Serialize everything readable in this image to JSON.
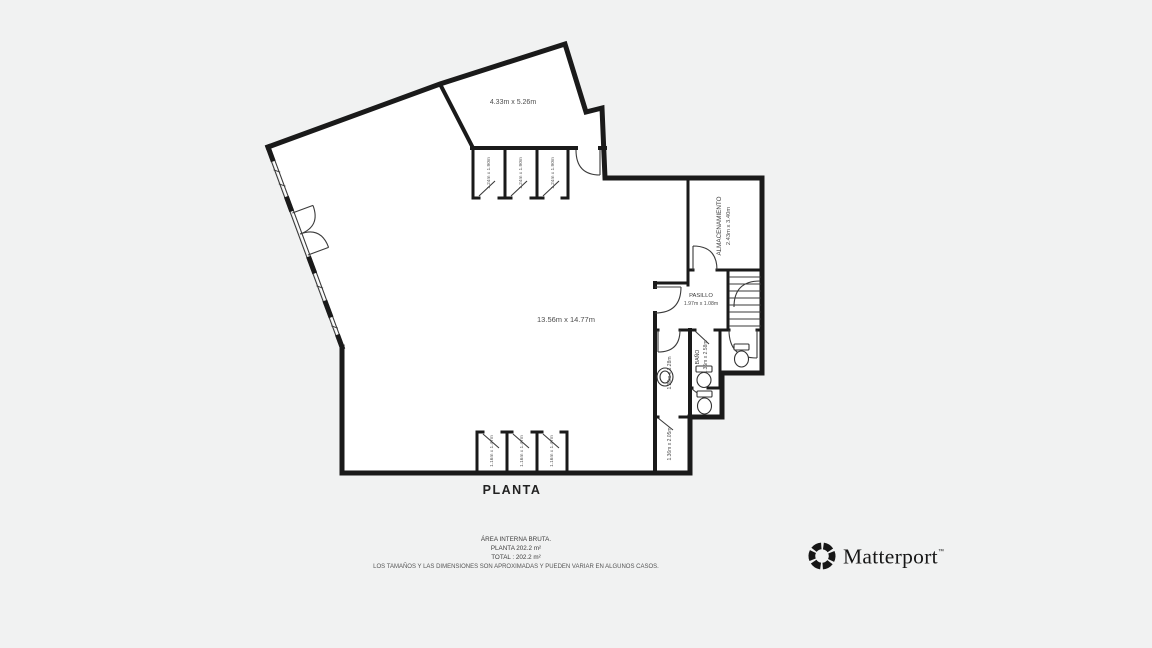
{
  "plan": {
    "title": "PLANTA",
    "wall_color": "#1a1a1a",
    "rooms": {
      "top_room": {
        "dims": "4.33m x 5.26m"
      },
      "main_room": {
        "dims": "13.56m x 14.77m"
      },
      "almacenamiento": {
        "name": "ALMACENAMIENTO",
        "dims": "2.43m x 3.40m"
      },
      "pasillo": {
        "name": "PASILLO",
        "dims": "1.97m x 1.08m"
      },
      "bano": {
        "name": "BAÑO",
        "dims": "1.35m x 2.58m"
      },
      "bath_left": {
        "dims": "1.26m x 3.28m"
      },
      "storage_small": {
        "dims": "1.36m x 2.05m"
      },
      "stall_top": {
        "dims": "1.24m x 1.90m"
      },
      "stall_bottom": {
        "dims": "1.16m x 1.47m"
      }
    }
  },
  "footer": {
    "area_heading": "ÁREA INTERNA BRUTA.",
    "area_planta": "PLANTA 202.2 m²",
    "area_total": "TOTAL :  202.2 m²",
    "disclaimer": "LOS TAMAÑOS Y LAS DIMENSIONES SON APROXIMADAS Y PUEDEN VARIAR EN ALGUNOS CASOS."
  },
  "branding": {
    "logo_text": "Matterport",
    "trademark": "™"
  }
}
